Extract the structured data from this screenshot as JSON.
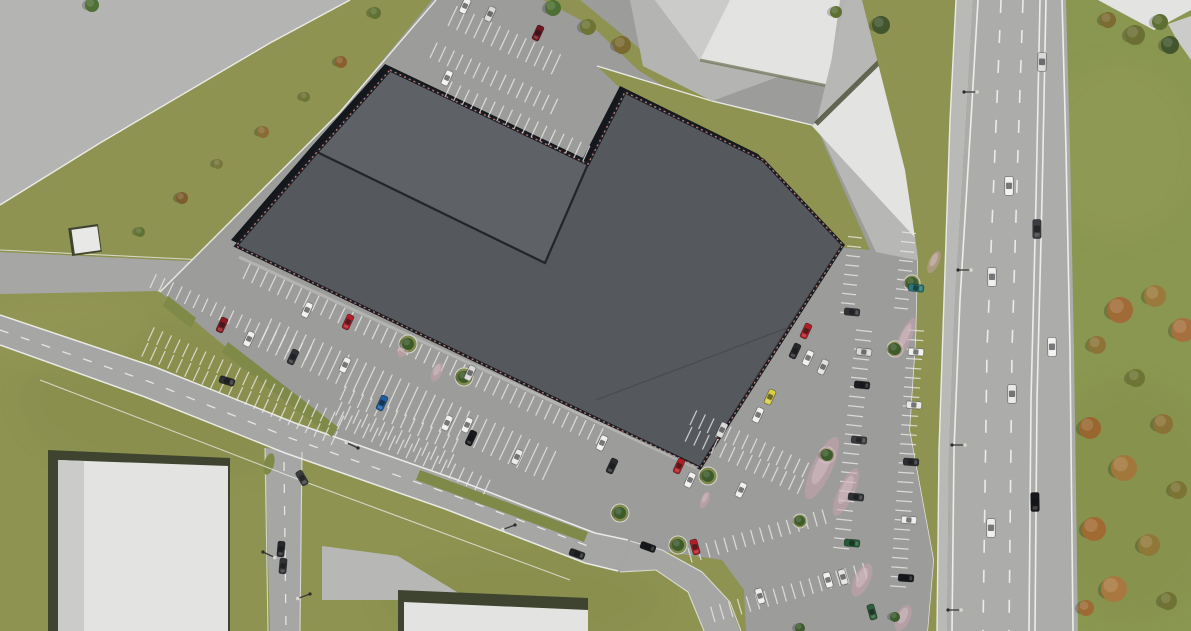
{
  "meta": {
    "title": "Aerial 3D site-plan rendering of a retail building with parking lots and highway",
    "view": "top-down orthographic render",
    "no_visible_text": true
  },
  "colors": {
    "grass": "#8e9351",
    "grassE": "#8a9750",
    "roadA": "#a6a7a5",
    "roadHwy": "#acacaa",
    "shoulder": "#b9b9b7",
    "lot": "#9c9d9b",
    "pave": "#b4b4b2",
    "whiteRoof": "#e3e3e1",
    "roof": "#55585c",
    "roofLight": "#5e6165",
    "roofEdge": "#14171c",
    "trim": "#c08076",
    "curb": "#f2f2f0",
    "stripe": "#eceae8",
    "island": "#7f8a49",
    "flower": "#c9a2ad",
    "shadow": "#3f4430"
  },
  "parking_rows": [
    [
      448,
      26,
      25,
      13,
      9.5,
      295,
      22
    ],
    [
      430,
      58,
      25,
      15,
      9.5,
      295,
      17
    ],
    [
      445,
      97,
      25,
      17,
      9.5,
      295,
      17
    ],
    [
      150,
      288,
      25,
      19,
      9.5,
      295,
      15
    ],
    [
      148,
      341,
      25,
      23,
      9.5,
      295,
      15
    ],
    [
      148,
      343,
      25,
      23,
      9.5,
      115,
      15
    ],
    [
      340,
      400,
      25,
      14,
      9.5,
      295,
      15
    ],
    [
      342,
      402,
      25,
      14,
      9.5,
      115,
      15
    ],
    [
      243,
      279,
      25,
      42,
      9.5,
      295,
      17
    ],
    [
      265,
      333,
      25,
      34,
      9.5,
      295,
      16
    ],
    [
      265,
      333,
      25,
      34,
      9.5,
      115,
      16
    ],
    [
      337,
      426,
      25,
      18,
      9.5,
      295,
      16
    ],
    [
      690,
      425,
      25,
      14,
      9.5,
      295,
      16
    ],
    [
      692,
      427,
      25,
      14,
      9.5,
      115,
      16
    ],
    [
      688,
      548,
      -16,
      16,
      9.3,
      74,
      15
    ],
    [
      715,
      622,
      -16,
      18,
      9.3,
      254,
      16
    ],
    [
      902,
      232,
      96,
      9,
      9.5,
      6,
      14
    ],
    [
      862,
      238,
      96,
      9,
      9.5,
      186,
      14
    ],
    [
      856,
      330,
      96,
      24,
      9.5,
      6,
      16
    ],
    [
      908,
      330,
      94,
      28,
      9.5,
      4,
      16
    ]
  ],
  "cars": [
    [
      465,
      6,
      115,
      "#eeeeec",
      0
    ],
    [
      490,
      14,
      115,
      "#d8d8d6",
      0
    ],
    [
      538,
      33,
      115,
      "#6f1620",
      0
    ],
    [
      447,
      78,
      115,
      "#f2f2f0",
      0
    ],
    [
      222,
      325,
      115,
      "#8c1a22",
      0
    ],
    [
      249,
      339,
      115,
      "#eeeeec",
      0
    ],
    [
      293,
      357,
      115,
      "#2f3134",
      0
    ],
    [
      345,
      365,
      115,
      "#eeeeec",
      0
    ],
    [
      382,
      403,
      115,
      "#1d5e9e",
      0
    ],
    [
      447,
      423,
      115,
      "#f0f0ee",
      0
    ],
    [
      307,
      310,
      115,
      "#f0f0ee",
      0
    ],
    [
      348,
      322,
      115,
      "#b01e27",
      0
    ],
    [
      470,
      373,
      115,
      "#d8d8d6",
      0
    ],
    [
      467,
      425,
      115,
      "#f0f0ee",
      0
    ],
    [
      471,
      438,
      115,
      "#17181b",
      0
    ],
    [
      517,
      457,
      115,
      "#e8e8e6",
      0
    ],
    [
      602,
      443,
      115,
      "#f0f0ee",
      0
    ],
    [
      612,
      466,
      115,
      "#26282b",
      0
    ],
    [
      679,
      466,
      115,
      "#b01e27",
      0
    ],
    [
      690,
      480,
      115,
      "#f0f0ee",
      0
    ],
    [
      770,
      397,
      115,
      "#d9cf45",
      0
    ],
    [
      758,
      415,
      115,
      "#f0f0ee",
      0
    ],
    [
      722,
      430,
      115,
      "#d8d8d6",
      0
    ],
    [
      806,
      331,
      115,
      "#b01e27",
      0
    ],
    [
      795,
      351,
      115,
      "#26282b",
      0
    ],
    [
      808,
      358,
      115,
      "#f0f0ee",
      0
    ],
    [
      823,
      367,
      115,
      "#e0e0de",
      0
    ],
    [
      741,
      490,
      115,
      "#eeeeec",
      0
    ],
    [
      695,
      547,
      74,
      "#b01e27",
      0
    ],
    [
      828,
      580,
      74,
      "#f0f0ee",
      0
    ],
    [
      843,
      577,
      74,
      "#e3e3e1",
      0
    ],
    [
      872,
      612,
      74,
      "#2e5e3a",
      0
    ],
    [
      760,
      596,
      74,
      "#eeeeec",
      0
    ],
    [
      916,
      288,
      6,
      "#2a7578",
      0
    ],
    [
      852,
      312,
      6,
      "#303235",
      0
    ],
    [
      864,
      352,
      6,
      "#d8d8d6",
      0
    ],
    [
      862,
      385,
      6,
      "#1b1d20",
      0
    ],
    [
      859,
      440,
      6,
      "#3a3c3f",
      0
    ],
    [
      856,
      497,
      6,
      "#2e3033",
      0
    ],
    [
      852,
      543,
      6,
      "#245c37",
      0
    ],
    [
      916,
      352,
      4,
      "#f0f0ee",
      0
    ],
    [
      914,
      405,
      4,
      "#e8e8e6",
      0
    ],
    [
      911,
      462,
      4,
      "#2b2d30",
      0
    ],
    [
      909,
      520,
      4,
      "#ededeb",
      0
    ],
    [
      906,
      578,
      4,
      "#17181b",
      0
    ],
    [
      227,
      381,
      17,
      "#2c2e31",
      0
    ],
    [
      577,
      554,
      20,
      "#232528",
      0
    ],
    [
      648,
      547,
      20,
      "#17181b",
      0
    ],
    [
      281,
      549,
      95,
      "#26282b",
      0
    ],
    [
      283,
      566,
      95,
      "#303235",
      0
    ],
    [
      302,
      478,
      60,
      "#3a3c3f",
      0
    ],
    [
      1042,
      62,
      91,
      "#d8d8d6",
      1
    ],
    [
      1009,
      186,
      90,
      "#f2f2f0",
      1
    ],
    [
      1037,
      229,
      90,
      "#3a3c3f",
      1
    ],
    [
      992,
      277,
      90,
      "#eeeeec",
      1
    ],
    [
      1052,
      347,
      89,
      "#f2f2f0",
      1
    ],
    [
      1012,
      394,
      90,
      "#e8e8e6",
      1
    ],
    [
      1035,
      502,
      89,
      "#17181b",
      1
    ],
    [
      991,
      528,
      90,
      "#ededeb",
      1
    ]
  ],
  "trees": [
    [
      375,
      13,
      6,
      "#5f7133"
    ],
    [
      341,
      62,
      6,
      "#8a5f2e"
    ],
    [
      305,
      97,
      5,
      "#6b7434"
    ],
    [
      263,
      132,
      6,
      "#8a6b33"
    ],
    [
      218,
      164,
      5,
      "#77763c"
    ],
    [
      182,
      198,
      6,
      "#7d5c2e"
    ],
    [
      140,
      232,
      5,
      "#5f7133"
    ],
    [
      92,
      5,
      7,
      "#4f7034"
    ],
    [
      553,
      8,
      8,
      "#4e6e33"
    ],
    [
      588,
      27,
      8,
      "#6d7434"
    ],
    [
      622,
      45,
      9,
      "#7a6a32"
    ],
    [
      881,
      25,
      9,
      "#42552c"
    ],
    [
      836,
      12,
      6,
      "#5d7032"
    ],
    [
      408,
      344,
      6,
      "#3d5c2c"
    ],
    [
      464,
      377,
      6,
      "#3d5c2c"
    ],
    [
      620,
      513,
      6,
      "#3d5c2c"
    ],
    [
      678,
      545,
      6,
      "#3d5c2c"
    ],
    [
      708,
      476,
      6,
      "#3d5c2c"
    ],
    [
      895,
      349,
      6,
      "#3d5c2c"
    ],
    [
      827,
      455,
      6,
      "#3d5c2c"
    ],
    [
      800,
      521,
      5,
      "#3d5c2c"
    ],
    [
      912,
      283,
      6,
      "#3d5c2c"
    ],
    [
      895,
      617,
      5,
      "#3d5c2c"
    ],
    [
      800,
      628,
      5,
      "#3d5c2c"
    ],
    [
      1108,
      20,
      8,
      "#7c6b33"
    ],
    [
      1135,
      35,
      10,
      "#6b6f33"
    ],
    [
      1160,
      22,
      8,
      "#5d7032"
    ],
    [
      1170,
      45,
      9,
      "#42552c"
    ],
    [
      1120,
      310,
      13,
      "#a06b36"
    ],
    [
      1155,
      296,
      11,
      "#9a7a3c"
    ],
    [
      1097,
      345,
      9,
      "#8c7438"
    ],
    [
      1183,
      330,
      12,
      "#a5703d"
    ],
    [
      1136,
      378,
      9,
      "#6d7434"
    ],
    [
      1090,
      428,
      11,
      "#99662f"
    ],
    [
      1163,
      424,
      10,
      "#8a7236"
    ],
    [
      1124,
      468,
      13,
      "#a1773c"
    ],
    [
      1178,
      490,
      9,
      "#7b7434"
    ],
    [
      1094,
      529,
      12,
      "#a26a33"
    ],
    [
      1149,
      545,
      11,
      "#8f7838"
    ],
    [
      1114,
      589,
      13,
      "#a87840"
    ],
    [
      1168,
      601,
      9,
      "#6f7233"
    ],
    [
      1086,
      608,
      8,
      "#9c6b34"
    ]
  ],
  "islands": [
    [
      408,
      344,
      9
    ],
    [
      464,
      377,
      9
    ],
    [
      620,
      513,
      9
    ],
    [
      678,
      545,
      9
    ],
    [
      708,
      476,
      9
    ],
    [
      895,
      349,
      8
    ],
    [
      827,
      455,
      8
    ],
    [
      800,
      521,
      7
    ],
    [
      912,
      283,
      8
    ]
  ],
  "flowers": [
    [
      822,
      468,
      10,
      34
    ],
    [
      846,
      492,
      8,
      26
    ],
    [
      905,
      338,
      6,
      22
    ],
    [
      862,
      580,
      8,
      18
    ],
    [
      903,
      618,
      7,
      14
    ],
    [
      437,
      372,
      5,
      10
    ],
    [
      404,
      348,
      5,
      10
    ],
    [
      934,
      262,
      5,
      12
    ],
    [
      705,
      500,
      4,
      9
    ]
  ],
  "lights": [
    [
      964,
      92,
      0
    ],
    [
      958,
      270,
      0
    ],
    [
      952,
      445,
      0
    ],
    [
      948,
      610,
      0
    ],
    [
      358,
      448,
      205
    ],
    [
      263,
      552,
      25
    ],
    [
      515,
      525,
      160
    ],
    [
      310,
      594,
      160
    ]
  ]
}
